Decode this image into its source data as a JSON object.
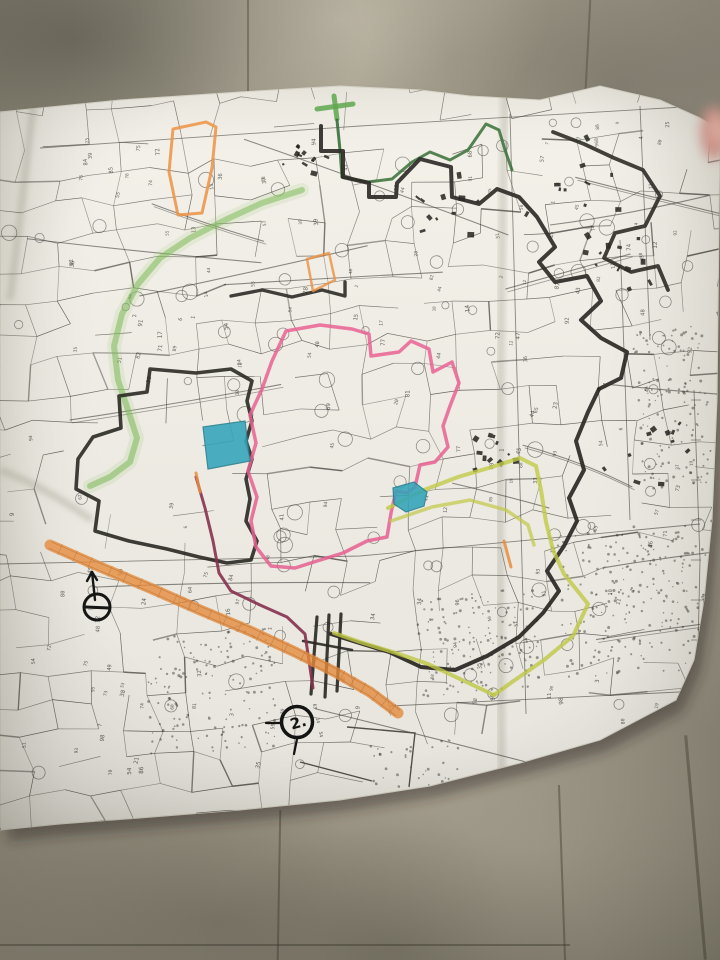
{
  "paper": {
    "fill": "#f4f2ea",
    "edge_stroke": "#d9d5c9",
    "outline": [
      [
        0,
        112
      ],
      [
        120,
        100
      ],
      [
        240,
        92
      ],
      [
        340,
        86
      ],
      [
        420,
        90
      ],
      [
        470,
        96
      ],
      [
        540,
        100
      ],
      [
        600,
        86
      ],
      [
        660,
        100
      ],
      [
        700,
        118
      ],
      [
        720,
        130
      ],
      [
        717,
        400
      ],
      [
        712,
        520
      ],
      [
        704,
        600
      ],
      [
        694,
        660
      ],
      [
        676,
        700
      ],
      [
        600,
        740
      ],
      [
        520,
        763
      ],
      [
        430,
        786
      ],
      [
        340,
        800
      ],
      [
        240,
        810
      ],
      [
        140,
        818
      ],
      [
        60,
        824
      ],
      [
        0,
        830
      ]
    ]
  },
  "print": {
    "line_color": "#3f3c38",
    "grid_lines": [
      {
        "name": "grid-top",
        "points": [
          [
            40,
            148
          ],
          [
            360,
            126
          ],
          [
            700,
            106
          ]
        ]
      },
      {
        "name": "grid-middle",
        "points": [
          [
            0,
            564
          ],
          [
            360,
            556
          ],
          [
            700,
            524
          ]
        ]
      },
      {
        "name": "grid-bottom-right",
        "points": [
          [
            390,
            706
          ],
          [
            720,
            690
          ]
        ]
      },
      {
        "name": "grid-vertical-center",
        "points": [
          [
            510,
            114
          ],
          [
            526,
            714
          ]
        ]
      },
      {
        "name": "grid-vertical-right-a",
        "points": [
          [
            640,
            106
          ],
          [
            650,
            340
          ]
        ]
      },
      {
        "name": "grid-vertical-right-b",
        "points": [
          [
            620,
            240
          ],
          [
            630,
            520
          ]
        ]
      },
      {
        "name": "neatline-right",
        "points": [
          [
            694,
            390
          ],
          [
            700,
            560
          ],
          [
            697,
            692
          ]
        ]
      }
    ]
  },
  "highlights": [
    {
      "name": "green-road-halo",
      "color": "#9cca72",
      "width": 14,
      "opacity": 0.16,
      "points": [
        [
          302,
          190
        ],
        [
          262,
          203
        ],
        [
          225,
          220
        ],
        [
          190,
          238
        ],
        [
          160,
          258
        ],
        [
          138,
          284
        ],
        [
          122,
          314
        ],
        [
          114,
          346
        ],
        [
          118,
          380
        ],
        [
          128,
          410
        ],
        [
          137,
          438
        ],
        [
          130,
          462
        ],
        [
          110,
          477
        ],
        [
          90,
          486
        ]
      ]
    },
    {
      "name": "green-road",
      "color": "#7cbb58",
      "width": 6,
      "opacity": 0.55,
      "points": [
        [
          302,
          190
        ],
        [
          262,
          203
        ],
        [
          225,
          220
        ],
        [
          190,
          238
        ],
        [
          160,
          258
        ],
        [
          138,
          284
        ],
        [
          122,
          314
        ],
        [
          114,
          346
        ],
        [
          118,
          380
        ],
        [
          128,
          410
        ],
        [
          137,
          438
        ],
        [
          130,
          462
        ],
        [
          110,
          477
        ],
        [
          90,
          486
        ]
      ]
    },
    {
      "name": "green-cross-h",
      "color": "#58a447",
      "width": 5,
      "opacity": 0.85,
      "points": [
        [
          317,
          109
        ],
        [
          353,
          104
        ]
      ]
    },
    {
      "name": "green-cross-v",
      "color": "#58a447",
      "width": 5,
      "opacity": 0.85,
      "points": [
        [
          334,
          96
        ],
        [
          337,
          119
        ]
      ]
    },
    {
      "name": "darkgreen-vertical",
      "color": "#2f6b2f",
      "width": 3,
      "opacity": 0.9,
      "points": [
        [
          337,
          120
        ],
        [
          340,
          150
        ],
        [
          342,
          177
        ]
      ]
    },
    {
      "name": "darkgreen-top",
      "color": "#2f6b2f",
      "width": 3,
      "opacity": 0.85,
      "points": [
        [
          342,
          177
        ],
        [
          368,
          182
        ],
        [
          392,
          179
        ],
        [
          412,
          162
        ],
        [
          430,
          152
        ],
        [
          450,
          160
        ],
        [
          468,
          150
        ],
        [
          486,
          124
        ],
        [
          499,
          130
        ],
        [
          505,
          150
        ],
        [
          512,
          170
        ]
      ]
    },
    {
      "name": "black-top-boundary",
      "color": "#26231f",
      "width": 4,
      "opacity": 0.92,
      "points": [
        [
          321,
          126
        ],
        [
          321,
          151
        ],
        [
          343,
          151
        ],
        [
          343,
          177
        ],
        [
          369,
          183
        ],
        [
          369,
          197
        ],
        [
          396,
          197
        ],
        [
          397,
          183
        ],
        [
          420,
          159
        ],
        [
          451,
          167
        ],
        [
          452,
          197
        ],
        [
          479,
          204
        ],
        [
          497,
          189
        ],
        [
          519,
          197
        ],
        [
          537,
          217
        ],
        [
          555,
          247
        ],
        [
          539,
          262
        ],
        [
          555,
          282
        ],
        [
          587,
          276
        ],
        [
          601,
          301
        ],
        [
          581,
          320
        ],
        [
          601,
          338
        ],
        [
          627,
          352
        ],
        [
          621,
          378
        ],
        [
          599,
          389
        ]
      ]
    },
    {
      "name": "black-right-boundary",
      "color": "#26231f",
      "width": 4,
      "opacity": 0.92,
      "points": [
        [
          599,
          389
        ],
        [
          588,
          412
        ],
        [
          576,
          441
        ],
        [
          584,
          470
        ],
        [
          569,
          498
        ],
        [
          577,
          521
        ],
        [
          564,
          546
        ],
        [
          547,
          571
        ],
        [
          559,
          591
        ],
        [
          543,
          613
        ],
        [
          519,
          637
        ],
        [
          487,
          656
        ],
        [
          455,
          670
        ],
        [
          421,
          667
        ],
        [
          389,
          652
        ],
        [
          353,
          641
        ],
        [
          331,
          634
        ]
      ]
    },
    {
      "name": "black-topright-cluster",
      "color": "#26231f",
      "width": 3.8,
      "opacity": 0.9,
      "points": [
        [
          553,
          132
        ],
        [
          584,
          144
        ],
        [
          614,
          158
        ],
        [
          643,
          170
        ],
        [
          660,
          196
        ],
        [
          645,
          226
        ],
        [
          615,
          233
        ],
        [
          604,
          258
        ],
        [
          631,
          272
        ],
        [
          658,
          266
        ],
        [
          668,
          290
        ]
      ]
    },
    {
      "name": "black-left-loop",
      "color": "#26231f",
      "width": 3.6,
      "opacity": 0.9,
      "closed": true,
      "points": [
        [
          150,
          369
        ],
        [
          147,
          392
        ],
        [
          119,
          396
        ],
        [
          121,
          428
        ],
        [
          93,
          437
        ],
        [
          78,
          459
        ],
        [
          76,
          489
        ],
        [
          99,
          501
        ],
        [
          95,
          531
        ],
        [
          129,
          541
        ],
        [
          167,
          549
        ],
        [
          199,
          557
        ],
        [
          227,
          563
        ],
        [
          251,
          560
        ],
        [
          257,
          541
        ],
        [
          246,
          521
        ],
        [
          250,
          499
        ],
        [
          246,
          479
        ],
        [
          252,
          459
        ],
        [
          246,
          441
        ],
        [
          252,
          421
        ],
        [
          247,
          401
        ],
        [
          252,
          381
        ],
        [
          231,
          369
        ],
        [
          196,
          373
        ]
      ]
    },
    {
      "name": "black-mid-step",
      "color": "#26231f",
      "width": 3.4,
      "opacity": 0.9,
      "points": [
        [
          231,
          296
        ],
        [
          262,
          290
        ],
        [
          292,
          297
        ],
        [
          322,
          290
        ],
        [
          345,
          296
        ],
        [
          345,
          282
        ]
      ]
    },
    {
      "name": "black-hatch-1",
      "color": "#26231f",
      "width": 3.2,
      "opacity": 0.9,
      "points": [
        [
          317,
          617
        ],
        [
          311,
          694
        ]
      ]
    },
    {
      "name": "black-hatch-2",
      "color": "#26231f",
      "width": 3.2,
      "opacity": 0.9,
      "points": [
        [
          329,
          615
        ],
        [
          325,
          697
        ]
      ]
    },
    {
      "name": "black-hatch-3",
      "color": "#26231f",
      "width": 3.2,
      "opacity": 0.9,
      "points": [
        [
          341,
          614
        ],
        [
          337,
          691
        ]
      ]
    },
    {
      "name": "black-hatch-cross",
      "color": "#26231f",
      "width": 2.5,
      "opacity": 0.9,
      "points": [
        [
          303,
          641
        ],
        [
          352,
          650
        ]
      ]
    },
    {
      "name": "pink-loop",
      "color": "#ee5f94",
      "width": 3.5,
      "opacity": 0.85,
      "closed": true,
      "points": [
        [
          286,
          331
        ],
        [
          320,
          325
        ],
        [
          352,
          329
        ],
        [
          369,
          334
        ],
        [
          371,
          356
        ],
        [
          399,
          352
        ],
        [
          411,
          341
        ],
        [
          429,
          349
        ],
        [
          433,
          372
        ],
        [
          452,
          362
        ],
        [
          459,
          383
        ],
        [
          450,
          406
        ],
        [
          443,
          426
        ],
        [
          448,
          447
        ],
        [
          435,
          462
        ],
        [
          420,
          465
        ],
        [
          415,
          487
        ],
        [
          407,
          493
        ],
        [
          396,
          491
        ],
        [
          391,
          513
        ],
        [
          387,
          537
        ],
        [
          367,
          541
        ],
        [
          343,
          553
        ],
        [
          317,
          561
        ],
        [
          295,
          568
        ],
        [
          271,
          566
        ],
        [
          256,
          547
        ],
        [
          251,
          521
        ],
        [
          257,
          497
        ],
        [
          248,
          471
        ],
        [
          256,
          443
        ],
        [
          250,
          415
        ],
        [
          262,
          389
        ],
        [
          272,
          361
        ]
      ]
    },
    {
      "name": "maroon-line",
      "color": "#8a2e4e",
      "width": 3,
      "opacity": 0.9,
      "points": [
        [
          196,
          477
        ],
        [
          205,
          508
        ],
        [
          213,
          541
        ],
        [
          219,
          573
        ],
        [
          231,
          591
        ],
        [
          260,
          605
        ],
        [
          287,
          617
        ],
        [
          305,
          634
        ],
        [
          309,
          661
        ],
        [
          313,
          688
        ]
      ]
    },
    {
      "name": "chartreuse-right",
      "color": "#c6cf45",
      "width": 4,
      "opacity": 0.8,
      "points": [
        [
          388,
          508
        ],
        [
          424,
          490
        ],
        [
          458,
          477
        ],
        [
          492,
          467
        ],
        [
          520,
          458
        ],
        [
          536,
          466
        ],
        [
          541,
          490
        ],
        [
          546,
          522
        ],
        [
          553,
          550
        ],
        [
          564,
          574
        ],
        [
          588,
          604
        ],
        [
          573,
          636
        ],
        [
          544,
          660
        ],
        [
          512,
          682
        ],
        [
          494,
          695
        ]
      ]
    },
    {
      "name": "chartreuse-bottom",
      "color": "#c6cf45",
      "width": 4,
      "opacity": 0.8,
      "points": [
        [
          494,
          695
        ],
        [
          460,
          679
        ],
        [
          428,
          664
        ],
        [
          396,
          653
        ],
        [
          360,
          642
        ],
        [
          334,
          633
        ]
      ]
    },
    {
      "name": "chartreuse-inner",
      "color": "#c6cf45",
      "width": 3.5,
      "opacity": 0.7,
      "points": [
        [
          391,
          521
        ],
        [
          432,
          507
        ],
        [
          470,
          500
        ],
        [
          506,
          510
        ],
        [
          528,
          525
        ],
        [
          534,
          545
        ]
      ]
    },
    {
      "name": "orange-road",
      "color": "#ef8f3c",
      "width": 11,
      "opacity": 0.8,
      "points": [
        [
          50,
          545
        ],
        [
          100,
          567
        ],
        [
          150,
          588
        ],
        [
          200,
          610
        ],
        [
          250,
          631
        ],
        [
          295,
          652
        ],
        [
          335,
          672
        ],
        [
          370,
          692
        ],
        [
          398,
          713
        ]
      ]
    },
    {
      "name": "orange-parcel-outline",
      "color": "#ef8f3c",
      "width": 3,
      "opacity": 0.85,
      "closed": true,
      "points": [
        [
          173,
          129
        ],
        [
          206,
          122
        ],
        [
          216,
          127
        ],
        [
          212,
          168
        ],
        [
          202,
          213
        ],
        [
          178,
          215
        ],
        [
          169,
          172
        ]
      ]
    },
    {
      "name": "orange-parcel-2",
      "color": "#ef8f3c",
      "width": 2.5,
      "opacity": 0.8,
      "closed": true,
      "points": [
        [
          307,
          259
        ],
        [
          329,
          253
        ],
        [
          335,
          280
        ],
        [
          313,
          291
        ]
      ]
    },
    {
      "name": "orange-dash-1",
      "color": "#ef8f3c",
      "width": 3,
      "opacity": 0.85,
      "points": [
        [
          196,
          473
        ],
        [
          200,
          492
        ]
      ]
    },
    {
      "name": "orange-dash-2",
      "color": "#ef8f3c",
      "width": 3,
      "opacity": 0.85,
      "points": [
        [
          504,
          541
        ],
        [
          511,
          567
        ]
      ]
    }
  ],
  "fills": [
    {
      "name": "teal-parcel-1",
      "fill": "#2fa8bf",
      "stroke": "#1d7f92",
      "opacity": 0.88,
      "points": [
        [
          203,
          427
        ],
        [
          245,
          421
        ],
        [
          250,
          461
        ],
        [
          208,
          469
        ]
      ]
    },
    {
      "name": "teal-parcel-2",
      "fill": "#2fa8bf",
      "stroke": "#1d7f92",
      "opacity": 0.88,
      "points": [
        [
          393,
          488
        ],
        [
          414,
          482
        ],
        [
          427,
          492
        ],
        [
          424,
          506
        ],
        [
          406,
          512
        ],
        [
          394,
          504
        ]
      ]
    }
  ],
  "markers": {
    "circle_dash": {
      "x": 97,
      "y": 607,
      "r": 13
    },
    "arrow": {
      "shaft": [
        [
          95,
          600
        ],
        [
          92,
          572
        ]
      ],
      "head_l": [
        [
          92,
          572
        ],
        [
          87,
          581
        ]
      ],
      "head_r": [
        [
          92,
          572
        ],
        [
          97,
          580
        ]
      ]
    },
    "circle_two": {
      "x": 297,
      "y": 722,
      "r": 15.5,
      "label": "2.",
      "rotate": -15
    },
    "circle_two_tail": [
      [
        297,
        739
      ],
      [
        294,
        754
      ]
    ],
    "circle_two_lead": [
      [
        266,
        723
      ],
      [
        281,
        723
      ]
    ],
    "sketch_rect": [
      [
        347,
        727
      ],
      [
        415,
        733
      ],
      [
        409,
        787
      ]
    ],
    "sketch_base": [
      [
        300,
        762
      ],
      [
        372,
        781
      ]
    ]
  },
  "fingertip": {
    "x": 714,
    "y": 133,
    "rx": 13,
    "ry": 27,
    "color": "#cf9186",
    "inner": "#e8b3a5"
  }
}
